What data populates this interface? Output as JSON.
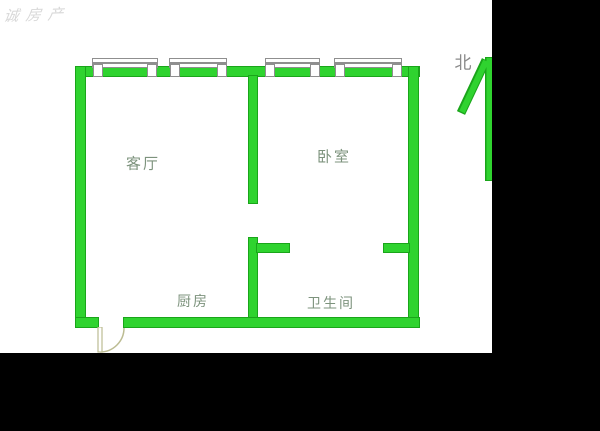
{
  "watermark": {
    "text": "诚房产"
  },
  "compass": {
    "label": "北"
  },
  "floor_plan": {
    "rooms": [
      {
        "id": "living-room",
        "label": "客厅"
      },
      {
        "id": "bedroom",
        "label": "卧室"
      },
      {
        "id": "kitchen",
        "label": "厨房"
      },
      {
        "id": "bathroom",
        "label": "卫生间"
      }
    ],
    "icons": [
      {
        "name": "window-symbol",
        "count": 4
      },
      {
        "name": "door-swing-icon"
      },
      {
        "name": "north-arrow-icon"
      }
    ],
    "colors": {
      "wall_fill": "#2fd32f",
      "wall_outline": "#1aa51a",
      "window_outline": "#8f8f8f",
      "door_outline": "#bcbc92",
      "room_label": "#7d937d",
      "north_label": "#8a8a8a",
      "watermark": "#d8d8d8",
      "mask": "#000000"
    }
  }
}
